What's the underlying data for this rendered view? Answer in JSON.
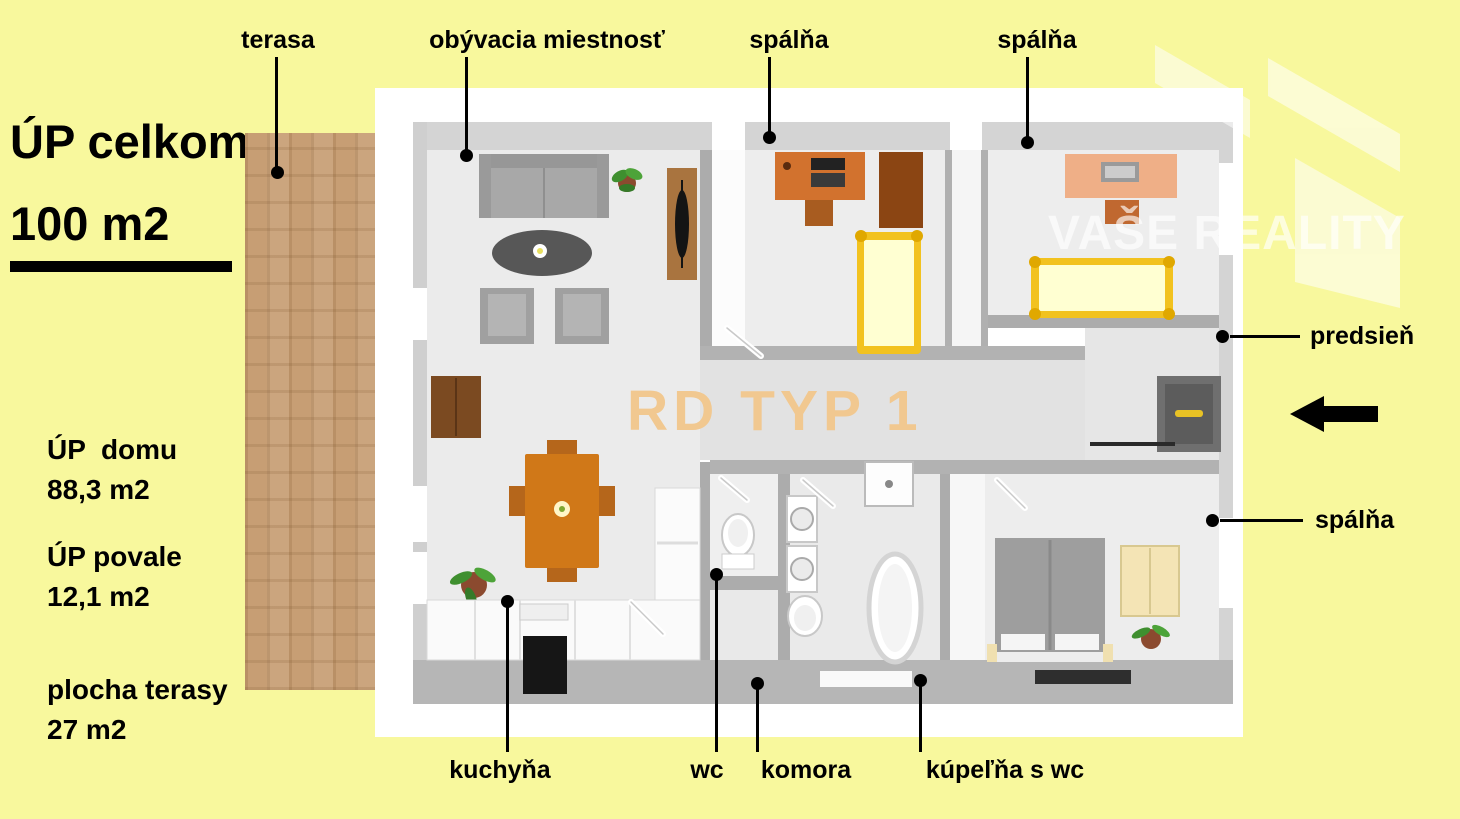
{
  "panel": {
    "title_line1": "ÚP celkom",
    "title_line2": "100 m2",
    "stats": [
      {
        "label": "ÚP  domu",
        "value": "88,3 m2"
      },
      {
        "label": "ÚP povale",
        "value": "12,1 m2"
      },
      {
        "label": "plocha terasy",
        "value": "27 m2"
      }
    ]
  },
  "room_labels": {
    "terasa": "terasa",
    "obyvacia_miestnost": "obývacia miestnosť",
    "spalna_top_left": "spálňa",
    "spalna_top_right": "spálňa",
    "predsien": "predsieň",
    "spalna_right": "spálňa",
    "kuchyna": "kuchyňa",
    "wc": "wc",
    "komora": "komora",
    "kupelna_s_wc": "kúpeľňa s wc"
  },
  "watermarks": {
    "plan_code": "RD TYP 1",
    "brand": "VAŠE REALITY"
  },
  "colors": {
    "background": "#F8F89D",
    "terrace": "#C79E74",
    "plan_code_text": "#F2C78C",
    "leader": "#000000"
  }
}
